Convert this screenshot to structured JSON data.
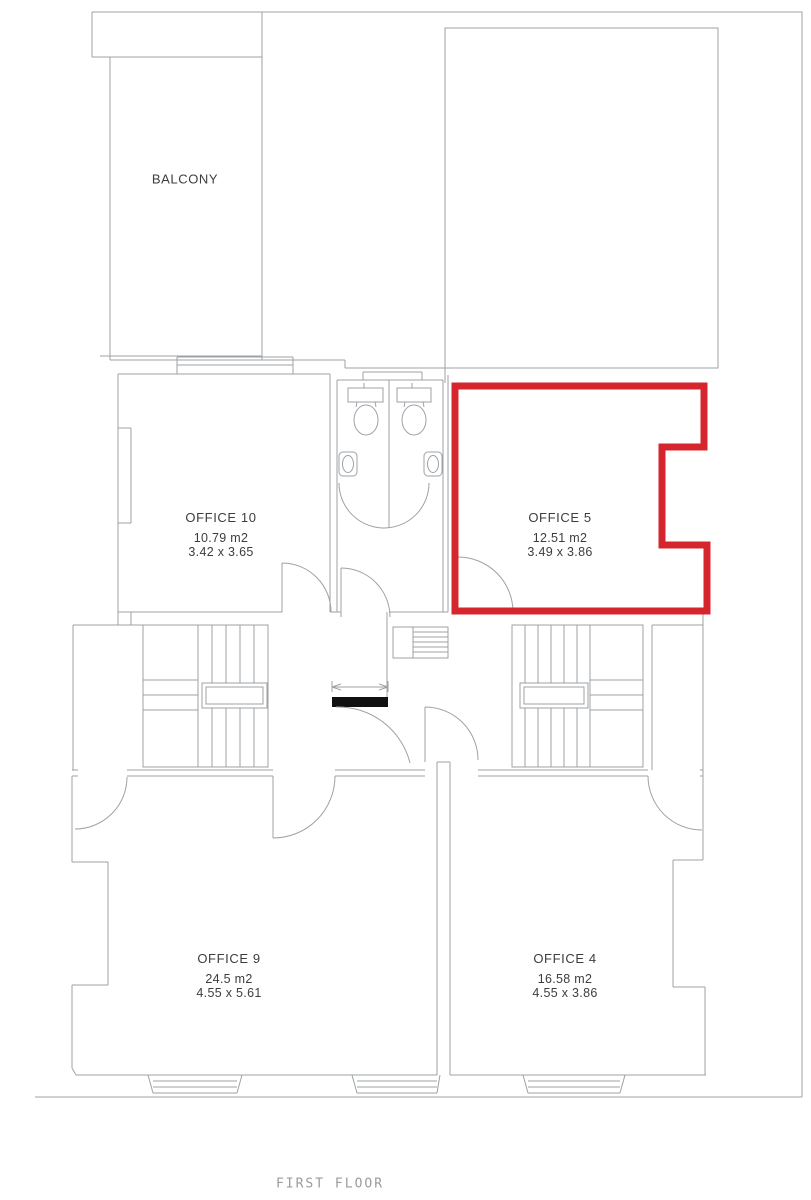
{
  "colors": {
    "highlight_red": "#d4262c",
    "line_gray": "#9da2a6",
    "text_dark": "#3d3d3d",
    "caption_gray": "#9b9b9b"
  },
  "rooms": [
    {
      "id": "balcony",
      "name": "BALCONY",
      "area": "",
      "dimensions": "",
      "highlighted": false
    },
    {
      "id": "office10",
      "name": "OFFICE 10",
      "area": "10.79 m2",
      "dimensions": "3.42 x 3.65",
      "highlighted": false
    },
    {
      "id": "office5",
      "name": "OFFICE 5",
      "area": "12.51 m2",
      "dimensions": "3.49 x 3.86",
      "highlighted": true
    },
    {
      "id": "office9",
      "name": "OFFICE 9",
      "area": "24.5 m2",
      "dimensions": "4.55 x 5.61",
      "highlighted": false
    },
    {
      "id": "office4",
      "name": "OFFICE 4",
      "area": "16.58 m2",
      "dimensions": "4.55 x 3.86",
      "highlighted": false
    }
  ],
  "footer": {
    "caption": "FIRST FLOOR"
  }
}
